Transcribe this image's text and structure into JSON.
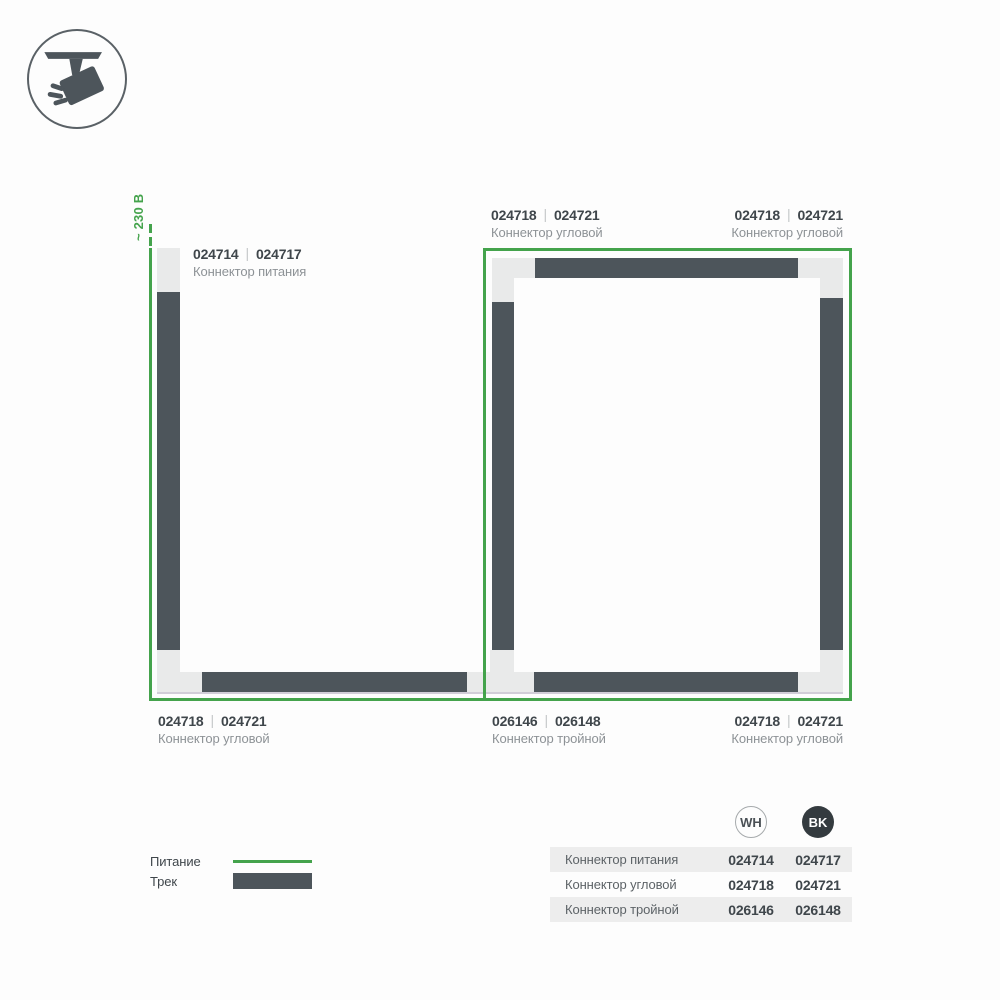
{
  "power": {
    "voltage_label": "~ 230 В"
  },
  "ui": {
    "separator": "|"
  },
  "icon": {
    "name": "track-spotlight"
  },
  "callouts": {
    "power": {
      "wh": "024714",
      "bk": "024717",
      "name": "Коннектор питания"
    },
    "corner_top_mid": {
      "wh": "024718",
      "bk": "024721",
      "name": "Коннектор угловой"
    },
    "corner_top_right": {
      "wh": "024718",
      "bk": "024721",
      "name": "Коннектор угловой"
    },
    "corner_bottom_left": {
      "wh": "024718",
      "bk": "024721",
      "name": "Коннектор угловой"
    },
    "triple_bottom_mid": {
      "wh": "026146",
      "bk": "026148",
      "name": "Коннектор тройной"
    },
    "corner_bottom_right": {
      "wh": "024718",
      "bk": "024721",
      "name": "Коннектор угловой"
    }
  },
  "legend": {
    "power_label": "Питание",
    "track_label": "Трек"
  },
  "table": {
    "columns": [
      {
        "code": "WH"
      },
      {
        "code": "BK"
      }
    ],
    "rows": [
      {
        "name": "Коннектор питания",
        "wh": "024714",
        "bk": "024717"
      },
      {
        "name": "Коннектор угловой",
        "wh": "024718",
        "bk": "024721"
      },
      {
        "name": "Коннектор тройной",
        "wh": "026146",
        "bk": "026148"
      }
    ]
  },
  "colors": {
    "power_line_green": "#44a34c",
    "track_dark": "#4d555b",
    "connector_light": "#e9eaea",
    "badge_bk": "#343b3f",
    "table_row_bg": "#ededed"
  }
}
